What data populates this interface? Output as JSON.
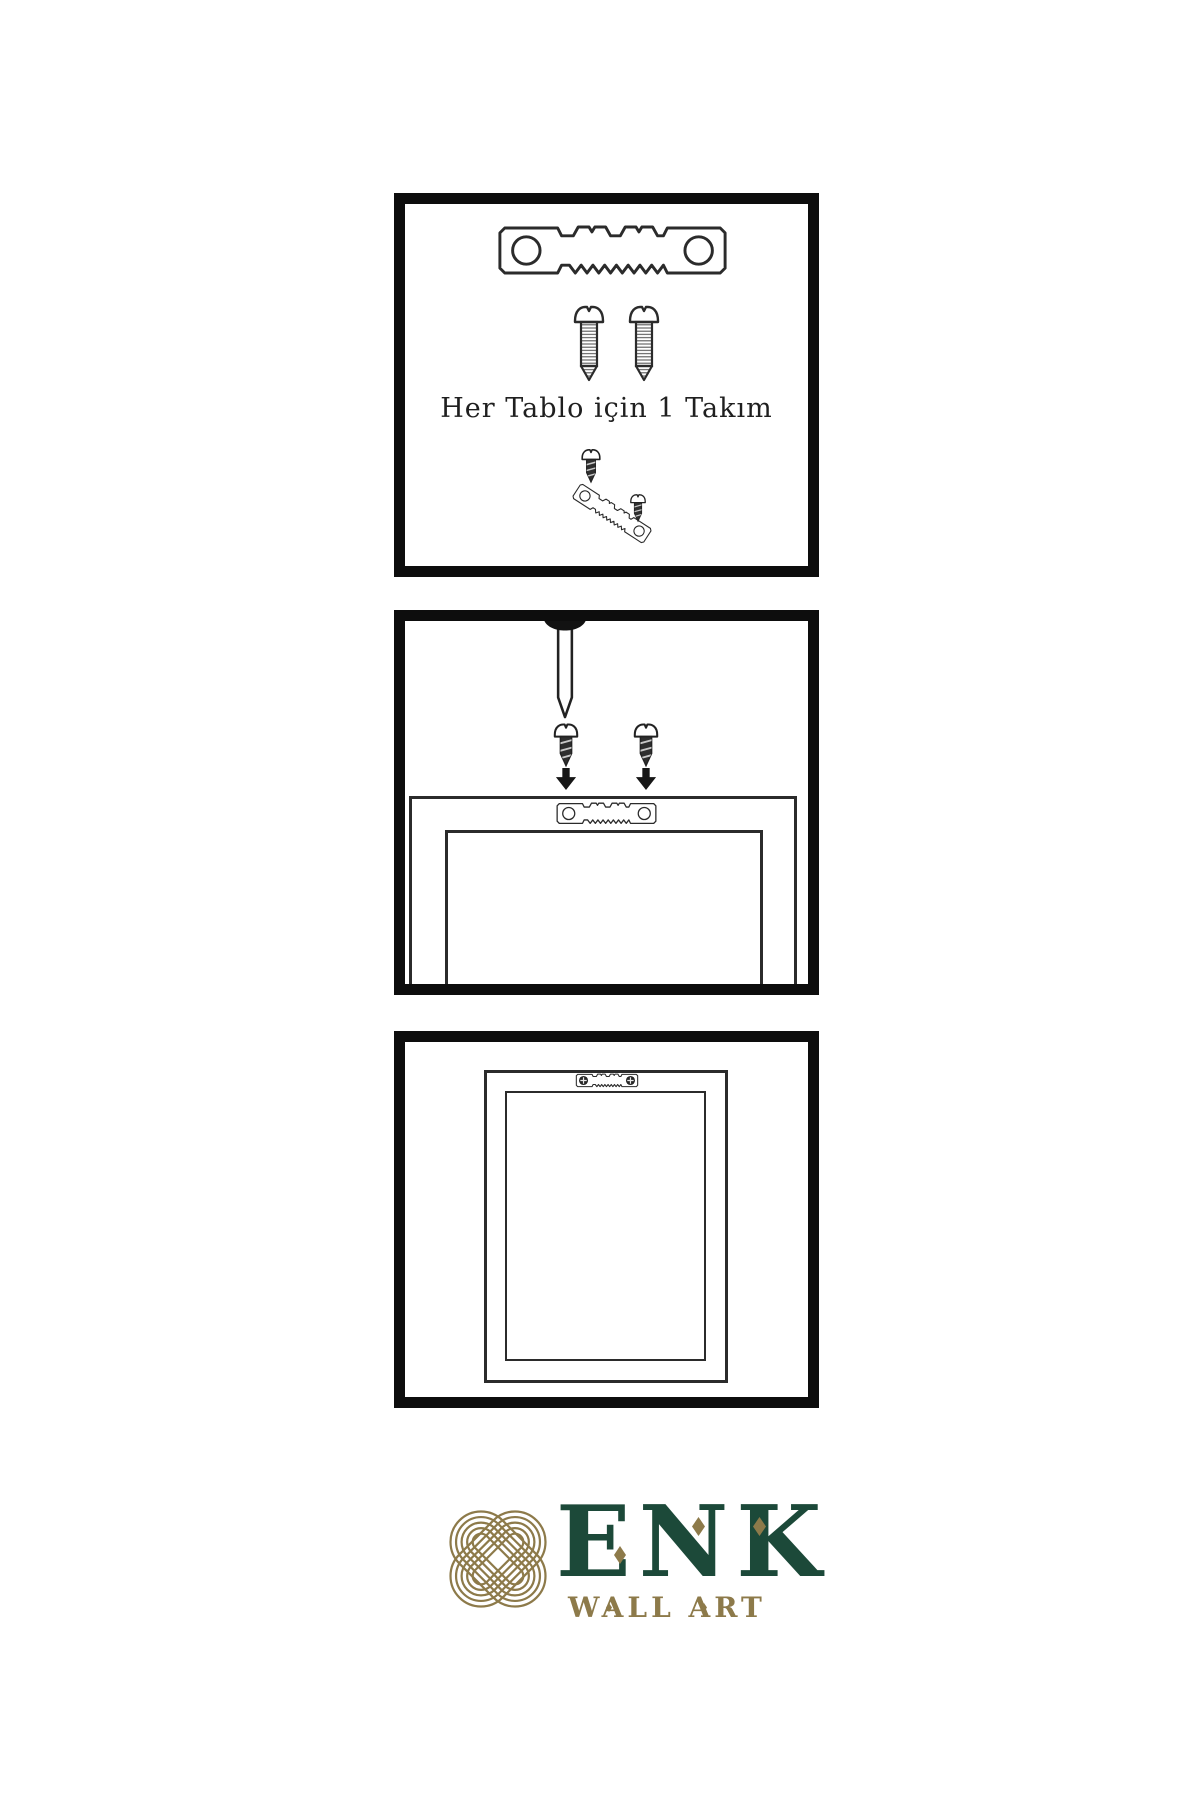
{
  "caption": {
    "text": "Her Tablo için 1 Takım"
  },
  "brand": {
    "name": "ENK",
    "subtitle": "WALL ART"
  },
  "colors": {
    "paper": "#ffffff",
    "panel_border": "#0d0d0d",
    "ink": "#2b2b2b",
    "brand_green": "#1c4939",
    "brand_gold": "#8d7a4a"
  },
  "panels": [
    {
      "name": "hardware-kit-panel",
      "icons": [
        "sawtooth-hanger-icon",
        "screw-icon",
        "screw-icon",
        "hanger-assembly-icon"
      ]
    },
    {
      "name": "mount-hanger-panel",
      "icons": [
        "wall-nail-icon",
        "dark-screw-icon",
        "dark-screw-icon",
        "arrow-down-icon",
        "arrow-down-icon",
        "sawtooth-hanger-icon",
        "frame-back-outline"
      ]
    },
    {
      "name": "hang-frame-panel",
      "icons": [
        "installed-sawtooth-hanger-icon",
        "frame-back-outline"
      ]
    }
  ],
  "logo_icons": [
    "knot-mark-icon",
    "diamond-accent-icon"
  ]
}
